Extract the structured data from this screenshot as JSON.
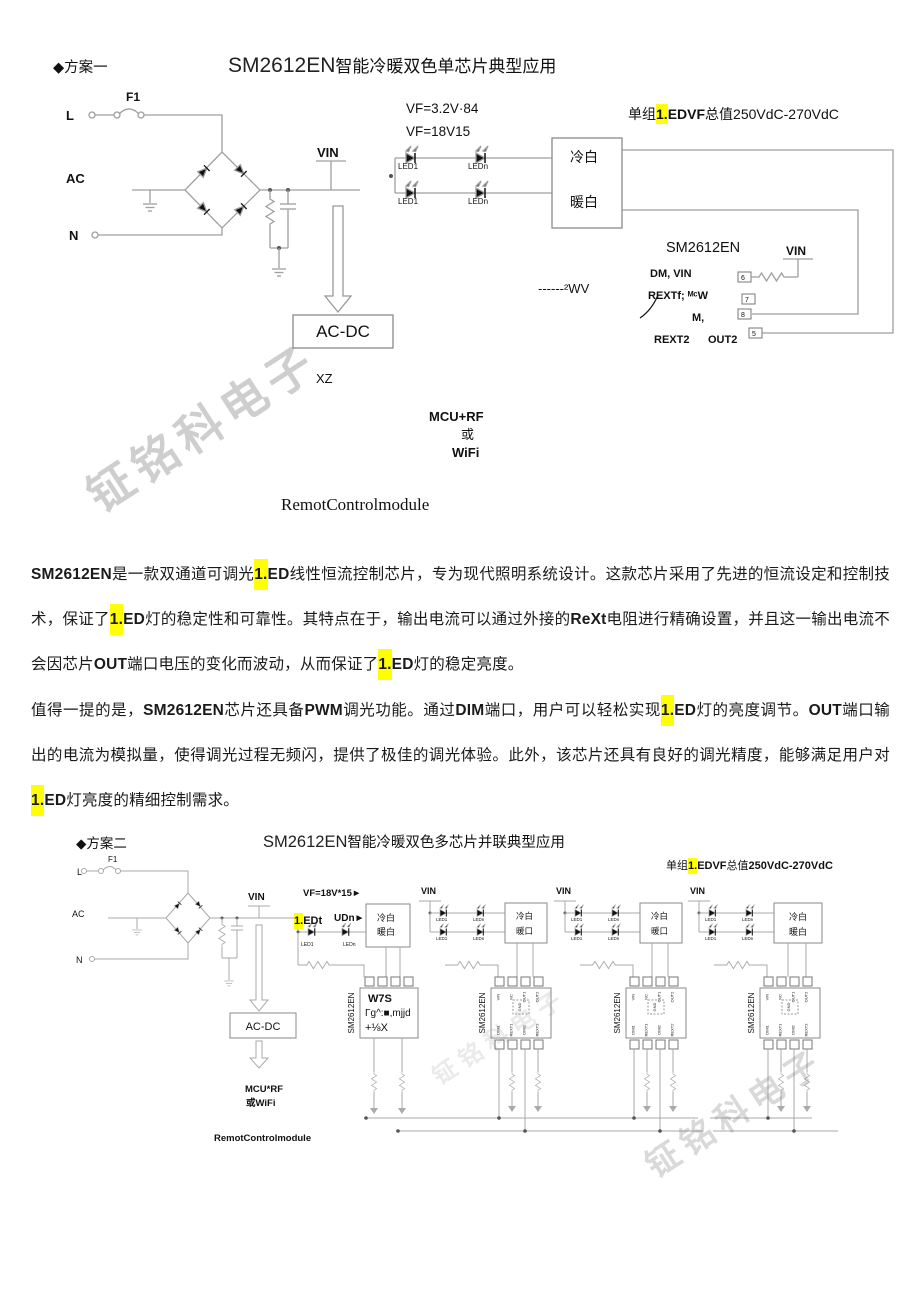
{
  "watermark": {
    "text": "钲铭科电子"
  },
  "scheme1": {
    "bullet": "◆方案一",
    "title_en": "SM2612EN",
    "title_zh": "智能冷暖双色单芯片典型应用",
    "group": [
      {
        "t": "单组"
      },
      {
        "t": "1.",
        "b": true,
        "h": true
      },
      {
        "t": "EDVF",
        "b": true
      },
      {
        "t": "总值"
      },
      {
        "t": "250VdC-270VdC"
      }
    ],
    "labels": {
      "l": "L",
      "f1": "F1",
      "ac": "AC",
      "n": "N",
      "vin": "VIN",
      "vf1": "VF=3.2V·84",
      "vf2": "VF=18V15",
      "led1": "LED1",
      "ledn": "LEDn",
      "cold": "冷白",
      "warm": "暖白",
      "chip": "SM2612EN",
      "pin_row1": "DM, VIN",
      "pin_row2": "REXTf; ᴹᶜW",
      "pin_row3": "M,",
      "pin_row4a": "REXT2",
      "pin_row4b": "OUT2",
      "vin2": "VIN",
      "res_note": "------²WV",
      "acdc": "AC-DC",
      "xz": "XZ",
      "mcu": "MCU+RF",
      "or": "或",
      "wifi": "WiFi",
      "remote": "RemotControlmodule"
    },
    "pins": [
      "6",
      "7",
      "8",
      "5"
    ]
  },
  "paragraphs": [
    {
      "segments": [
        {
          "t": "SM2612EN",
          "b": true
        },
        {
          "t": "是一款双通道可调光"
        },
        {
          "t": "1.",
          "b": true,
          "h": true
        },
        {
          "t": "ED",
          "b": true
        },
        {
          "t": "线性恒流控制芯片，专为现代照明系统设计。这款芯片采用了先进的恒流设定和控制技术，保证了"
        },
        {
          "t": "1.",
          "b": true,
          "h": true
        },
        {
          "t": "ED",
          "b": true
        },
        {
          "t": "灯的稳定性和可靠性。其特点在于，输出电流可以通过外接的"
        },
        {
          "t": "ReXt",
          "b": true
        },
        {
          "t": "电阻进行精确设置，并且这一输出电流不会因芯片"
        },
        {
          "t": "OUT",
          "b": true
        },
        {
          "t": "端口电压的变化而波动，从而保证了"
        },
        {
          "t": "1.",
          "b": true,
          "h": true
        },
        {
          "t": "ED",
          "b": true
        },
        {
          "t": "灯的稳定亮度。"
        }
      ]
    },
    {
      "segments": [
        {
          "t": "值得一提的是，"
        },
        {
          "t": "SM2612EN",
          "b": true
        },
        {
          "t": "芯片还具备"
        },
        {
          "t": "PWM",
          "b": true
        },
        {
          "t": "调光功能。通过"
        },
        {
          "t": "DIM",
          "b": true
        },
        {
          "t": "端口，用户可以轻松实现"
        },
        {
          "t": "1.",
          "b": true,
          "h": true
        },
        {
          "t": "ED",
          "b": true
        },
        {
          "t": "灯的亮度调节。"
        },
        {
          "t": "OUT",
          "b": true
        },
        {
          "t": "端口输出的电流为模拟量，使得调光过程无频闪，提供了极佳的调光体验。此外，该芯片还具有良好的调光精度，能够满足用户对"
        },
        {
          "t": "1.",
          "b": true,
          "h": true
        },
        {
          "t": "ED",
          "b": true
        },
        {
          "t": "灯亮度的精细控制需求。"
        }
      ]
    }
  ],
  "scheme2": {
    "bullet": "◆方案二",
    "title_en": "SM2612EN",
    "title_zh": "智能冷暖双色多芯片并联典型应用",
    "group": [
      {
        "t": "单组"
      },
      {
        "t": "1.",
        "b": true,
        "h": true
      },
      {
        "t": "EDVF",
        "b": true
      },
      {
        "t": "总值"
      },
      {
        "t": "250VdC-270VdC",
        "b": true
      }
    ],
    "labels": {
      "l": "L",
      "f1": "F1",
      "ac": "AC",
      "n": "N",
      "vin": "VIN",
      "vf": "VF=18V*15►",
      "acdc": "AC-DC",
      "mcu": "MCU*RF",
      "orwifi": "或WiFi",
      "remote": "RemotControlmodule",
      "led1": "LED1",
      "ledn": "LEDn",
      "cold": "冷白",
      "warm": "暖白",
      "warm_alt": "暖口"
    },
    "led_big": [
      {
        "t": "1.",
        "b": true,
        "h": true
      },
      {
        "t": "EDt",
        "b": true
      }
    ],
    "led_big2": "UDn►",
    "chip_name": "SM2612EN",
    "chip0_lines": [
      "W7S",
      "Γg^:■,mjjd",
      "+⅛X"
    ],
    "gnd": "GND",
    "pins_top": [
      "VIN",
      "NC",
      "OUT1",
      "OUT2"
    ],
    "pins_top_nums": [
      "8",
      "7",
      "6",
      "5"
    ],
    "pins_bottom": [
      "DIM1",
      "REXT1",
      "DIM2",
      "REXT2"
    ],
    "pins_bottom_nums": [
      "1",
      "2",
      "3",
      "4"
    ]
  }
}
